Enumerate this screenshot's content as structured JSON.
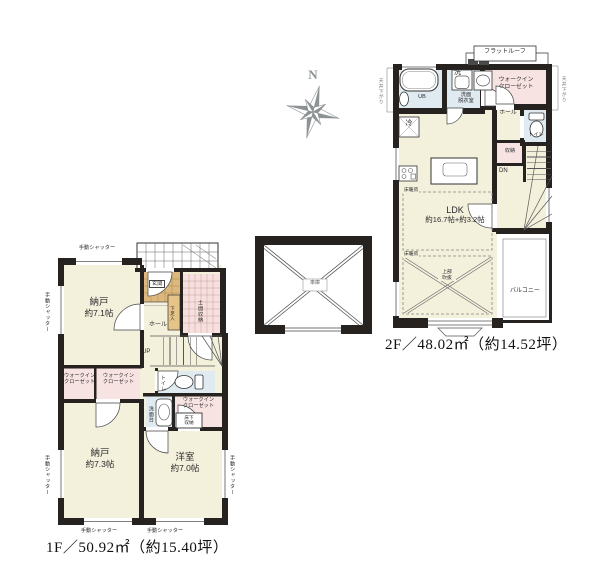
{
  "labels": {
    "manual_shutter": "手動シャッター",
    "wic_lines": [
      "ウォークイン",
      "クローゼット"
    ],
    "ceiling_lowered": "天井下がり",
    "floor_heating": "床暖房"
  },
  "compass": {
    "north": "N"
  },
  "garage": {
    "label": "車庫"
  },
  "floor1": {
    "area_label": "1F／50.92㎡（約15.40坪）",
    "storage_71": {
      "name": "納戸",
      "size": "約7.1帖"
    },
    "storage_73": {
      "name": "納戸",
      "size": "約7.3帖"
    },
    "western_room": {
      "name": "洋室",
      "size": "約7.0帖"
    },
    "entrance": "玄関",
    "hall": "ホール",
    "doma_storage": "土間収納",
    "shoe_storage": "下足入",
    "toilet": "トイレ",
    "vanity": "洗面台",
    "underfloor_lines": [
      "床下",
      "収納"
    ],
    "stairs_up": "UP"
  },
  "floor2": {
    "area_label": "2F／48.02㎡（約14.52坪）",
    "flat_roof": "フラットルーフ",
    "ldk_name": "LDK",
    "ldk_size": "約16.7帖+約3.2帖",
    "unit_bath": "UB",
    "washer": "洗",
    "washroom_lines": [
      "洗面",
      "脱衣室"
    ],
    "toilet": "トイレ",
    "hall": "ホール",
    "storage": "収納",
    "stairs_down": "DN",
    "fridge": "冷",
    "void_lines": [
      "上部",
      "吹抜"
    ],
    "balcony": "バルコニー"
  }
}
